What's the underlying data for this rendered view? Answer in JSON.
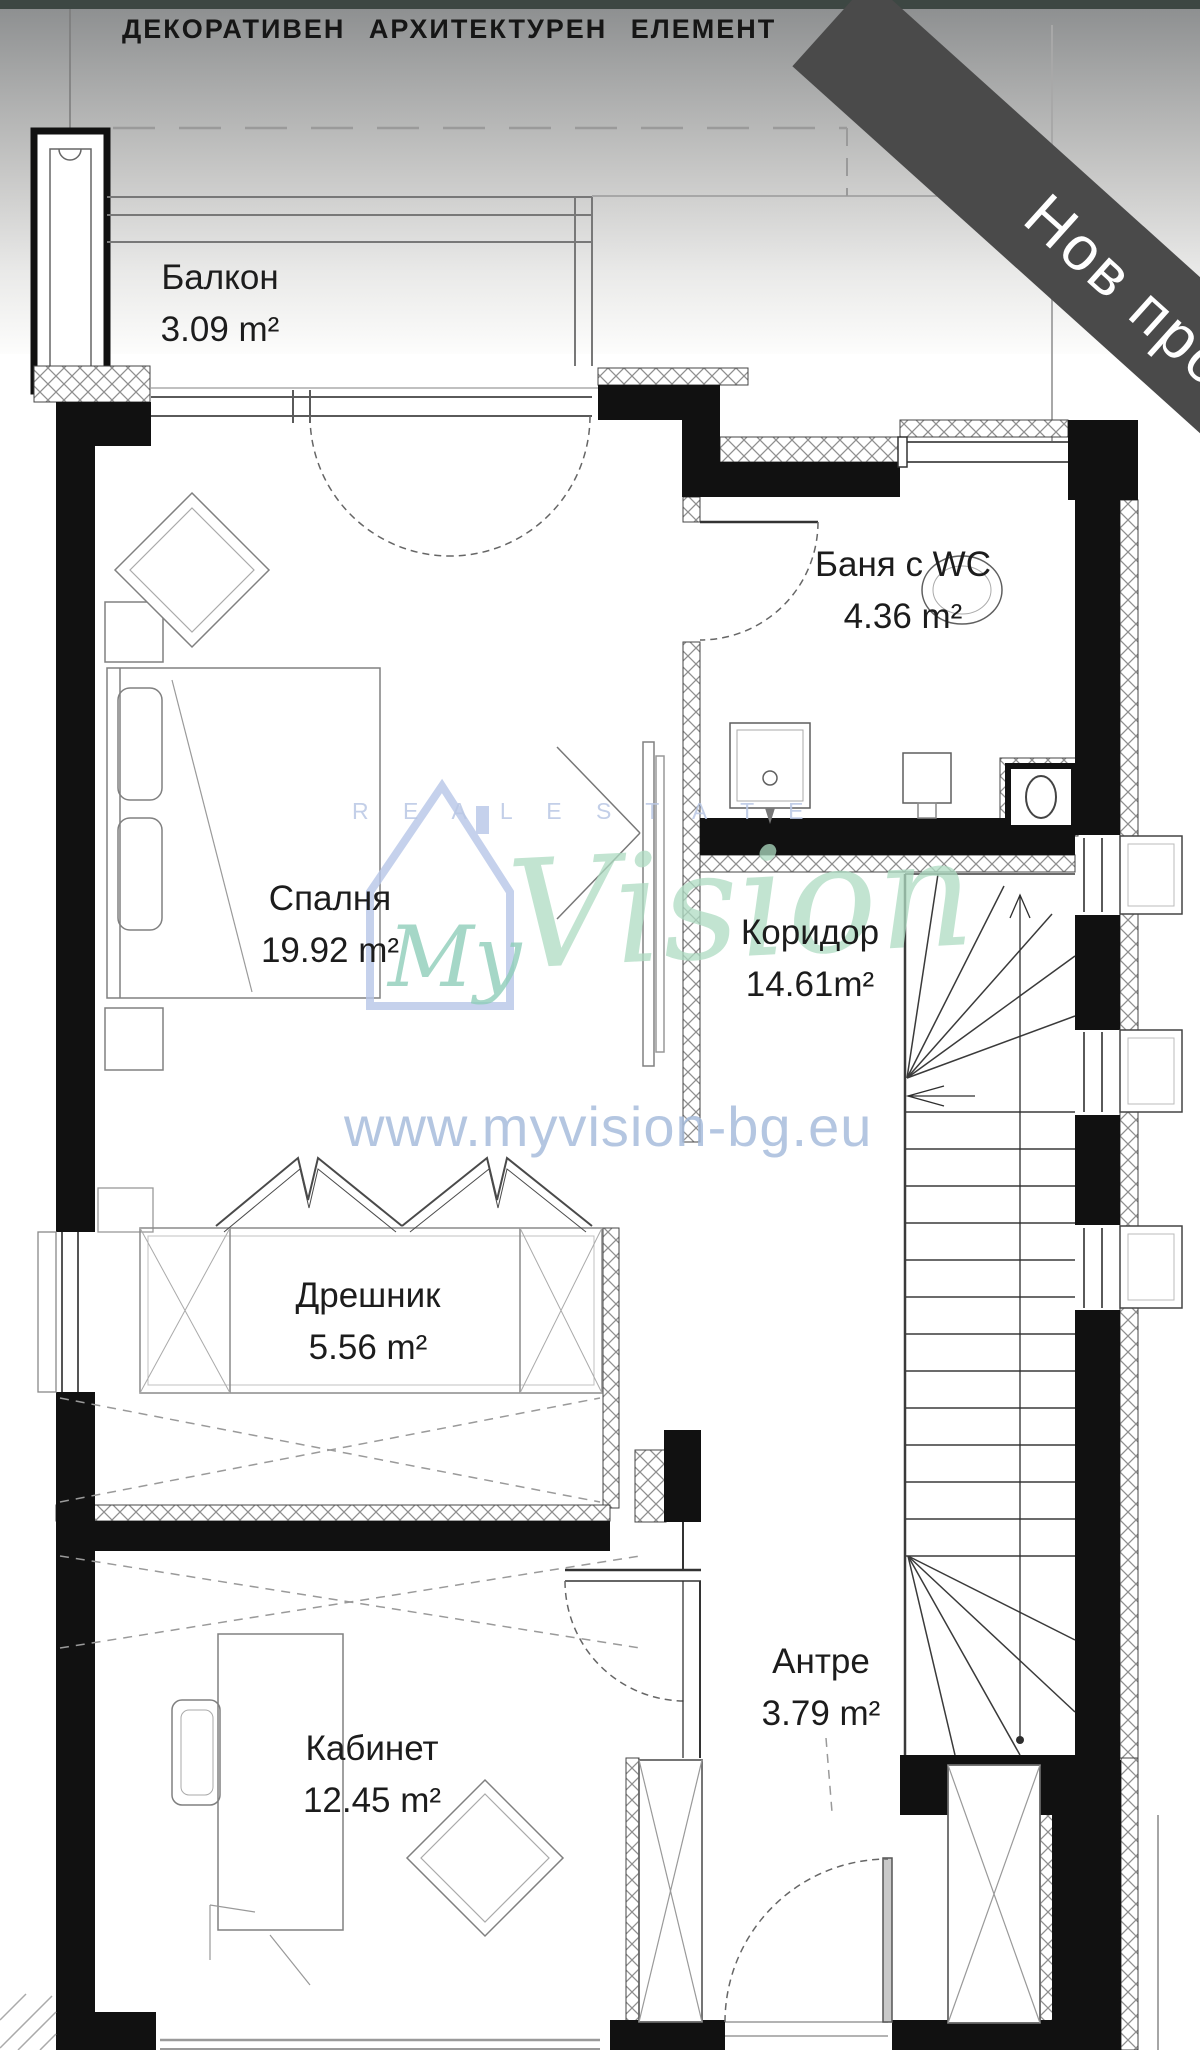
{
  "meta": {
    "type": "architectural-floor-plan",
    "language": "bg"
  },
  "header": {
    "title": "ДЕКОРАТИВЕН АРХИТЕКТУРЕН ЕЛЕМЕНТ"
  },
  "banner": {
    "label": "Нов проект"
  },
  "rooms": [
    {
      "key": "balcony",
      "name": "Балкон",
      "area": "3.09 m²"
    },
    {
      "key": "bedroom",
      "name": "Спалня",
      "area": "19.92 m²"
    },
    {
      "key": "bathroom",
      "name": "Баня с WC",
      "area": "4.36 m²"
    },
    {
      "key": "corridor",
      "name": "Коридор",
      "area": "14.61m²"
    },
    {
      "key": "dressing",
      "name": "Дрешник",
      "area": "5.56 m²"
    },
    {
      "key": "office",
      "name": "Кабинет",
      "area": "12.45 m²"
    },
    {
      "key": "entry",
      "name": "Антре",
      "area": "3.79 m²"
    }
  ],
  "watermark": {
    "brand_my": "My",
    "brand_vision": "Vision",
    "tagline": "R E A L   E S T A T E",
    "url": "www.myvision-bg.eu"
  },
  "colors": {
    "top_strip": "#3d4743",
    "banner_bg": "#4a4a4a",
    "banner_text": "#ffffff",
    "wall": "#111111",
    "label_text": "#1c1c1c",
    "watermark_blue": "#aabdd8",
    "watermark_green": "#8fceba"
  }
}
